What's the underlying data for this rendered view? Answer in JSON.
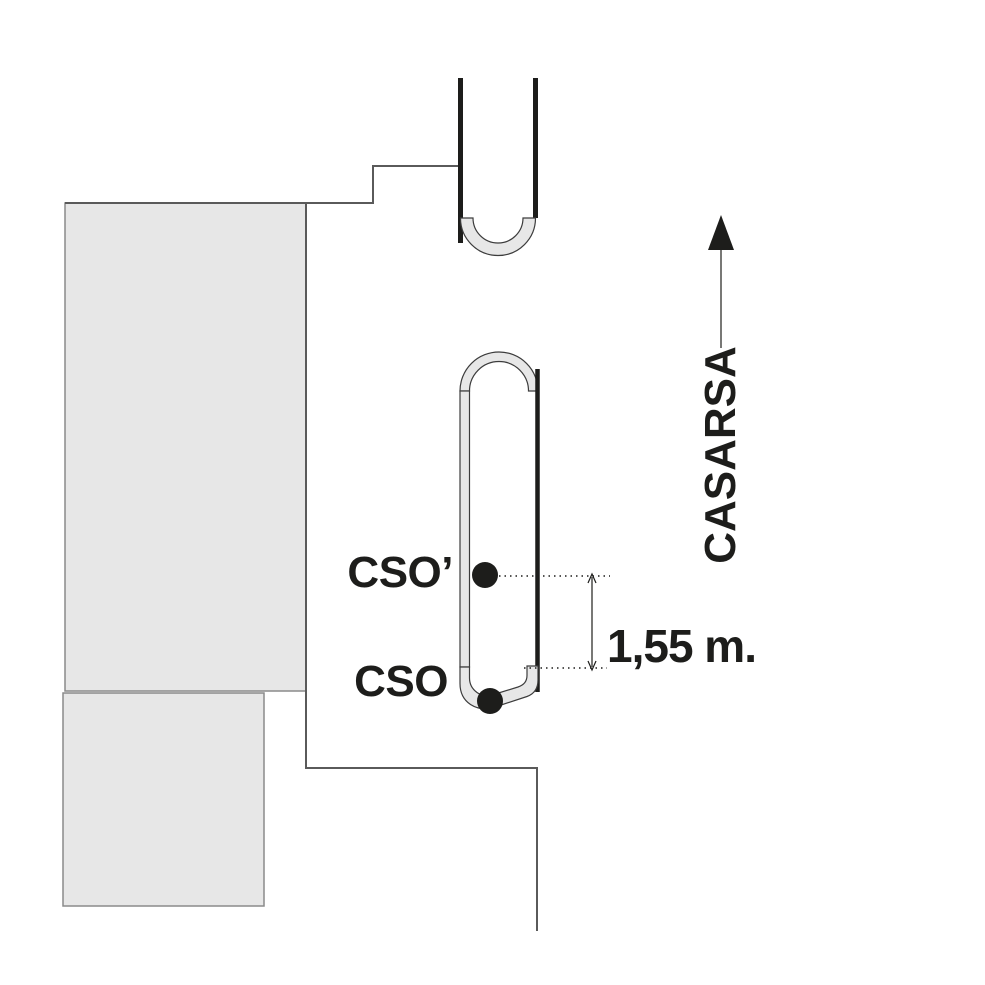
{
  "diagram": {
    "points": [
      {
        "label": "CSO’"
      },
      {
        "label": "CSO"
      }
    ],
    "measurement": {
      "label": "1,55 m."
    },
    "street": {
      "label": "CASARSA"
    }
  },
  "colors": {
    "background": "#ffffff",
    "block-fill": "#e7e7e7",
    "block-stroke": "#8a8a8a",
    "street-stroke": "#5a5a5a",
    "island-stroke": "#3c3c3c",
    "ink": "#1d1d1b"
  }
}
